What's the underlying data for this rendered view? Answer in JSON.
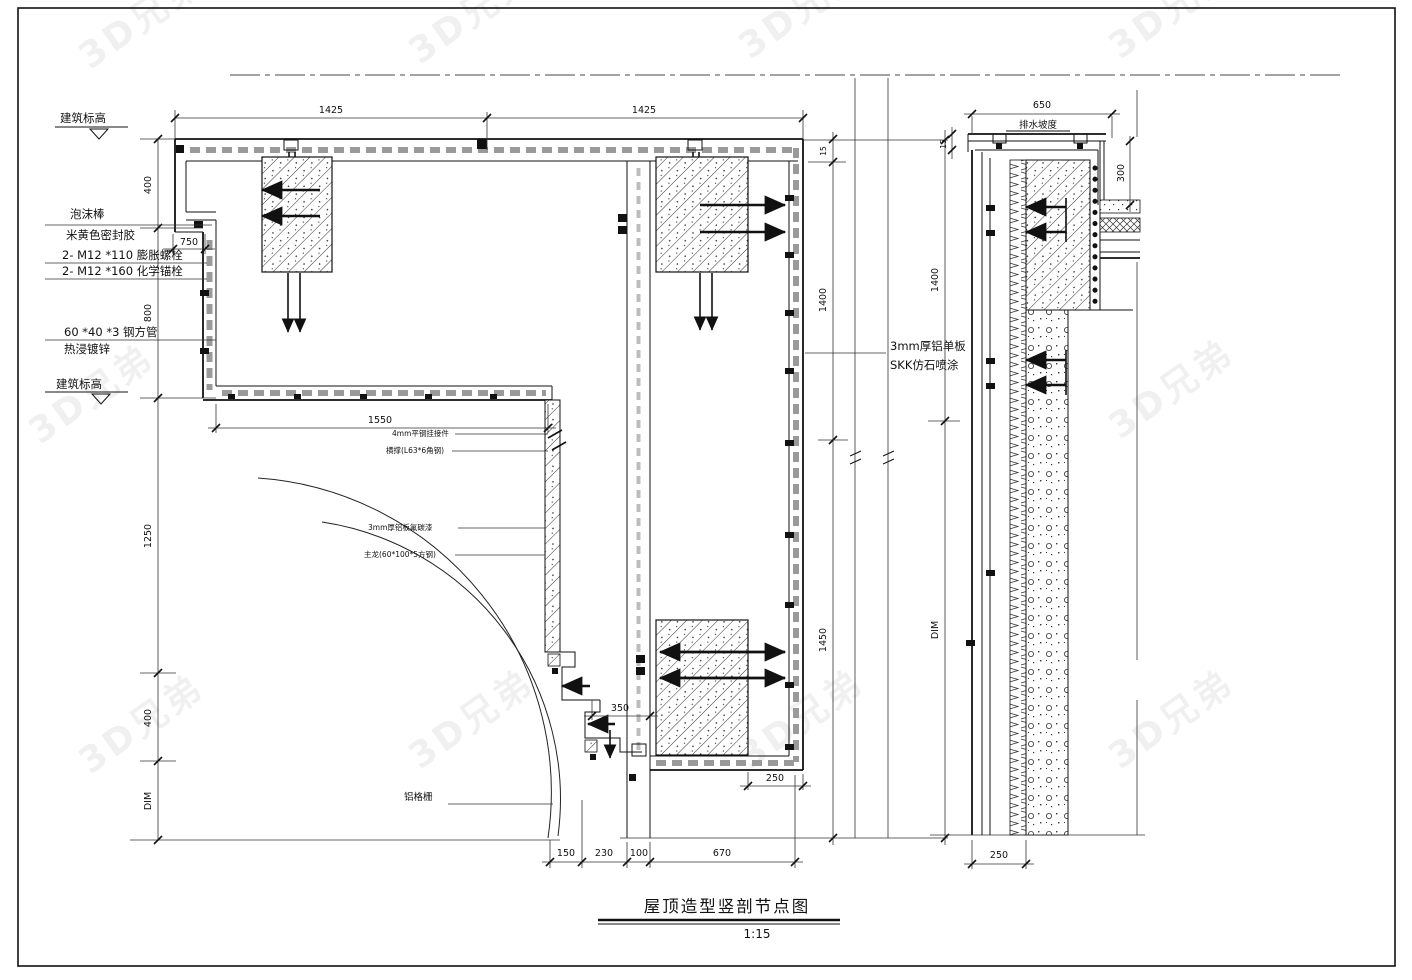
{
  "watermark": {
    "text": "3D兄弟"
  },
  "title_block": {
    "title": "屋顶造型竖剖节点图",
    "scale": "1:15"
  },
  "labels": {
    "elev_top": "建筑标高",
    "foam_rod": "泡沫棒",
    "sealant": "米黄色密封胶",
    "bolt1": "2- M12 *110 膨胀螺栓",
    "bolt2": "2- M12 *160 化学锚栓",
    "tube": "60 *40 *3 钢方管",
    "galv": "热浸镀锌",
    "elev_bottom": "建筑标高",
    "clip": "4mm平钢挂接件",
    "brace": "横撑(L63*6角钢)",
    "alu_paint": "3mm厚铝板氟碳漆",
    "keel": "主龙(60*100*5方钢)",
    "grille": "铝格栅",
    "alu_sheet": "3mm厚铝单板",
    "skk": "SKK仿石喷涂",
    "slope": "排水坡度"
  },
  "dims": {
    "top_a": "1425",
    "top_b": "1425",
    "d750": "750",
    "left": [
      "400",
      "800",
      "1250",
      "400",
      "DIM"
    ],
    "d1550": "1550",
    "right": [
      "15",
      "1400",
      "1450"
    ],
    "far": [
      "1400",
      "DIM"
    ],
    "bottom": [
      "150",
      "230",
      "100",
      "670"
    ],
    "d350": "350",
    "d250a": "250",
    "detail": {
      "w": "650",
      "t": "15",
      "h": "300",
      "b": "250"
    }
  }
}
